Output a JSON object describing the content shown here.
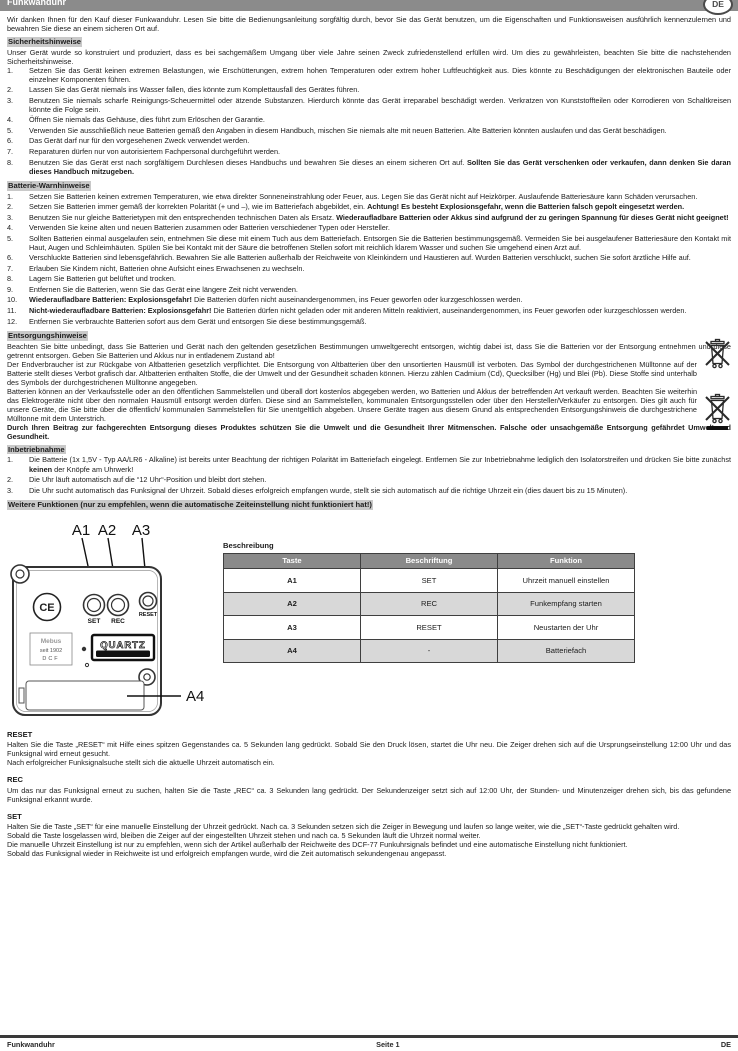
{
  "header": {
    "title": "Funkwanduhr",
    "lang_badge": "DE"
  },
  "intro": "Wir danken Ihnen für den Kauf dieser Funkwanduhr. Lesen Sie bitte die Bedienungsanleitung sorgfältig durch, bevor Sie das Gerät benutzen, um die Eigenschaften und Funktionsweisen ausführlich kennenzulernen und bewahren Sie diese an einem sicheren Ort auf.",
  "safety": {
    "heading": "Sicherheitshinweise",
    "intro": "Unser Gerät wurde so konstruiert und produziert, dass es bei sachgemäßem Umgang über viele Jahre seinen Zweck zufriedenstellend erfüllen wird. Um dies zu gewährleisten, beachten Sie bitte die nachstehenden Sicherheitshinweise.",
    "items": [
      {
        "num": "1.",
        "seg": [
          {
            "t": "Setzen Sie das Gerät keinen extremen Belastungen, wie Erschütterungen, extrem hohen Temperaturen oder extrem hoher Luftfeuchtigkeit aus. Dies könnte zu Beschädigungen der elektronischen Bauteile oder einzelner Komponenten führen."
          }
        ]
      },
      {
        "num": "2.",
        "seg": [
          {
            "t": "Lassen Sie das Gerät niemals ins Wasser fallen, dies könnte zum Komplettausfall des Gerätes führen."
          }
        ]
      },
      {
        "num": "3.",
        "seg": [
          {
            "t": "Benutzen Sie niemals scharfe Reinigungs-Scheuermittel oder ätzende Substanzen. Hierdurch könnte das Gerät irreparabel beschädigt werden. Verkratzen von Kunststoffteilen oder Korrodieren von Schaltkreisen könnte die Folge sein."
          }
        ]
      },
      {
        "num": "4.",
        "seg": [
          {
            "t": "Öffnen Sie niemals das Gehäuse, dies führt zum Erlöschen der Garantie."
          }
        ]
      },
      {
        "num": "5.",
        "seg": [
          {
            "t": "Verwenden Sie ausschließlich neue Batterien gemäß den Angaben in diesem Handbuch, mischen Sie niemals alte mit neuen Batterien. Alte Batterien könnten auslaufen und das Gerät beschädigen."
          }
        ]
      },
      {
        "num": "6.",
        "seg": [
          {
            "t": "Das Gerät darf nur für den vorgesehenen Zweck verwendet werden."
          }
        ]
      },
      {
        "num": "7.",
        "seg": [
          {
            "t": "Reparaturen dürfen nur von autorisiertem Fachpersonal durchgeführt werden."
          }
        ]
      },
      {
        "num": "8.",
        "seg": [
          {
            "t": "Benutzen Sie das Gerät erst nach sorgfältigem Durchlesen dieses Handbuchs und bewahren Sie dieses an einem sicheren Ort auf. "
          },
          {
            "t": "Sollten Sie das Gerät verschenken oder verkaufen, dann denken Sie daran dieses Handbuch mitzugeben.",
            "b": true
          }
        ]
      }
    ]
  },
  "battery": {
    "heading": "Batterie-Warnhinweise",
    "items": [
      {
        "num": "1.",
        "seg": [
          {
            "t": "Setzen Sie Batterien keinen extremen Temperaturen, wie etwa direkter Sonneneinstrahlung oder Feuer, aus. Legen Sie das Gerät nicht auf Heizkörper. Auslaufende Batteriesäure kann Schäden verursachen."
          }
        ]
      },
      {
        "num": "2.",
        "seg": [
          {
            "t": "Setzen Sie Batterien immer gemäß der korrekten Polarität (+ und –), wie im Batteriefach abgebildet, ein. "
          },
          {
            "t": "Achtung! Es besteht Explosionsgefahr, wenn die Batterien falsch gepolt eingesetzt werden.",
            "b": true
          }
        ]
      },
      {
        "num": "3.",
        "seg": [
          {
            "t": "Benutzen Sie nur gleiche Batterietypen mit den entsprechenden technischen Daten als Ersatz. "
          },
          {
            "t": "Wiederaufladbare Batterien oder Akkus sind aufgrund der zu geringen Spannung für dieses Gerät nicht geeignet!",
            "b": true
          }
        ]
      },
      {
        "num": "4.",
        "seg": [
          {
            "t": "Verwenden Sie keine alten und neuen Batterien zusammen oder Batterien verschiedener Typen oder Hersteller."
          }
        ]
      },
      {
        "num": "5.",
        "seg": [
          {
            "t": "Sollten Batterien einmal ausgelaufen sein, entnehmen Sie diese mit einem Tuch aus dem Batteriefach. Entsorgen Sie die Batterien bestimmungsgemäß. Vermeiden Sie bei ausgelaufener Batteriesäure den Kontakt mit Haut, Augen und Schleimhäuten. Spülen Sie bei Kontakt mit der Säure die betroffenen Stellen sofort mit reichlich klarem Wasser und suchen Sie umgehend einen Arzt auf."
          }
        ]
      },
      {
        "num": "6.",
        "seg": [
          {
            "t": "Verschluckte Batterien sind lebensgefährlich. Bewahren Sie alle Batterien außerhalb der Reichweite von Kleinkindern und Haustieren auf. Wurden Batterien verschluckt, suchen Sie sofort ärztliche Hilfe auf."
          }
        ]
      },
      {
        "num": "7.",
        "seg": [
          {
            "t": "Erlauben Sie Kindern nicht, Batterien ohne Aufsicht eines Erwachsenen zu wechseln."
          }
        ]
      },
      {
        "num": "8.",
        "seg": [
          {
            "t": "Lagern Sie Batterien gut belüftet und trocken."
          }
        ]
      },
      {
        "num": "9.",
        "seg": [
          {
            "t": "Entfernen Sie die Batterien, wenn Sie das Gerät eine längere Zeit nicht verwenden."
          }
        ]
      },
      {
        "num": "10.",
        "seg": [
          {
            "t": "Wiederaufladbare Batterien: Explosionsgefahr! ",
            "b": true
          },
          {
            "t": "Die Batterien dürfen nicht auseinandergenommen, ins Feuer geworfen oder kurzgeschlossen werden."
          }
        ]
      },
      {
        "num": "11.",
        "seg": [
          {
            "t": "Nicht-wiederaufladbare Batterien: Explosionsgefahr! ",
            "b": true
          },
          {
            "t": "Die Batterien dürfen nicht geladen oder mit anderen Mitteln reaktiviert, auseinandergenommen, ins Feuer geworfen oder kurzgeschlossen werden."
          }
        ]
      },
      {
        "num": "12.",
        "seg": [
          {
            "t": "Entfernen Sie verbrauchte Batterien sofort aus dem Gerät und entsorgen Sie diese bestimmungsgemäß."
          }
        ]
      }
    ]
  },
  "disposal": {
    "heading": "Entsorgungshinweise",
    "paragraphs": [
      {
        "seg": [
          {
            "t": "Beachten Sie bitte unbedingt, dass Sie Batterien und Gerät nach den geltenden gesetzlichen Bestimmungen umweltgerecht entsorgen, wichtig dabei ist, dass Sie die Batterien vor der Entsorgung entnehmen und diese getrennt entsorgen. Geben Sie Batterien und Akkus nur in entladenem Zustand ab!"
          }
        ]
      },
      {
        "seg": [
          {
            "t": "Der Endverbraucher ist zur Rückgabe von Altbatterien gesetzlich verpflichtet. Die Entsorgung von Altbatterien über den unsortierten Hausmüll ist verboten. Das Symbol der durchgestrichenen Mülltonne auf der Batterie stellt dieses Verbot grafisch dar. Altbatterien enthalten Stoffe, die der Umwelt und der Gesundheit schaden können. Hierzu zählen Cadmium (Cd), Quecksilber (Hg) und Blei (Pb). Diese Stoffe sind unterhalb des Symbols der durchgestrichenen Mülltonne angegeben."
          }
        ]
      },
      {
        "seg": [
          {
            "t": "Batterien können an der Verkaufsstelle oder an den öffentlichen Sammelstellen und überall dort kostenlos abgegeben werden, wo Batterien und Akkus der betreffenden Art verkauft werden. Beachten Sie weiterhin das Elektrogeräte nicht über den normalen Hausmüll entsorgt werden dürfen. Diese sind an Sammelstellen, kommunalen Entsorgungsstellen oder über den Hersteller/Verkäufer zu entsorgen. Dies gilt auch für unsere Geräte, die Sie bitte über die öffentlich/ kommunalen Sammelstellen für Sie unentgeltlich abgeben. Unsere Geräte tragen aus diesem Grund als entsprechenden Entsorgungshinweis die durchgestrichene Mülltonne mit dem Unterstrich."
          }
        ]
      },
      {
        "seg": [
          {
            "t": "Durch Ihren Beitrag zur fachgerechten Entsorgung dieses Produktes schützen Sie die Umwelt und die Gesundheit Ihrer Mitmenschen. Falsche oder unsachgemäße Entsorgung gefährdet Umwelt und Gesundheit.",
            "b": true
          }
        ]
      }
    ]
  },
  "setup": {
    "heading": "Inbetriebnahme",
    "items": [
      {
        "num": "1.",
        "seg": [
          {
            "t": "Die Batterie (1x 1,5V - Typ AA/LR6 - Alkaline) ist bereits unter Beachtung der richtigen Polarität im Batteriefach eingelegt. Entfernen Sie zur Inbetriebnahme lediglich den Isolatorstreifen und drücken Sie bitte zunächst "
          },
          {
            "t": "keinen",
            "b": true
          },
          {
            "t": " der Knöpfe am Uhrwerk!"
          }
        ]
      },
      {
        "num": "2.",
        "seg": [
          {
            "t": "Die Uhr läuft automatisch auf die “12 Uhr“-Position und bleibt dort stehen."
          }
        ]
      },
      {
        "num": "3.",
        "seg": [
          {
            "t": "Die Uhr sucht automatisch das Funksignal der Uhrzeit. Sobald dieses erfolgreich empfangen wurde, stellt sie sich automatisch auf die richtige Uhrzeit ein (dies dauert bis zu 15 Minuten)."
          }
        ]
      }
    ]
  },
  "more_functions": {
    "heading": "Weitere Funktionen (nur zu empfehlen, wenn die automatische Zeiteinstellung nicht funktioniert hat!)"
  },
  "diagram": {
    "labels": {
      "a1": "A1",
      "a2": "A2",
      "a3": "A3",
      "a4": "A4"
    },
    "buttons": {
      "set": "SET",
      "rec": "REC",
      "reset": "RESET"
    },
    "ce_mark": "CE",
    "badge": "QUARTZ",
    "sticker": {
      "line1": "Mebus",
      "line2": "seit 1902",
      "line3": "DCF"
    }
  },
  "table": {
    "title": "Beschreibung",
    "headers": [
      "Taste",
      "Beschriftung",
      "Funktion"
    ],
    "rows": [
      [
        "A1",
        "SET",
        "Uhrzeit manuell einstellen"
      ],
      [
        "A2",
        "REC",
        "Funkempfang starten"
      ],
      [
        "A3",
        "RESET",
        "Neustarten der Uhr"
      ],
      [
        "A4",
        "-",
        "Batteriefach"
      ]
    ]
  },
  "reset_section": {
    "heading": "RESET",
    "paragraphs": [
      "Halten Sie die Taste „RESET“ mit Hilfe eines spitzen Gegenstandes ca. 5 Sekunden lang gedrückt. Sobald Sie den Druck lösen, startet die Uhr neu. Die Zeiger drehen sich auf die Ursprungseinstellung 12:00 Uhr und das Funksignal wird erneut gesucht.",
      "Nach erfolgreicher Funksignalsuche stellt sich die aktuelle Uhrzeit automatisch ein."
    ]
  },
  "rec_section": {
    "heading": "REC",
    "paragraphs": [
      "Um das nur das Funksignal erneut zu suchen, halten Sie die Taste „REC“ ca. 3 Sekunden lang gedrückt. Der Sekundenzeiger setzt sich auf 12:00 Uhr, der Stunden- und Minutenzeiger drehen sich, bis das gefundene Funksignal erkannt wurde."
    ]
  },
  "set_section": {
    "heading": "SET",
    "paragraphs": [
      "Halten Sie die Taste „SET“ für eine manuelle Einstellung der Uhrzeit gedrückt. Nach ca. 3 Sekunden setzen sich die Zeiger in Bewegung und laufen so lange weiter, wie die „SET“-Taste gedrückt gehalten wird.",
      "Sobald die Taste losgelassen wird, bleiben die Zeiger auf der eingestellten Uhrzeit stehen und nach ca. 5 Sekunden läuft die Uhrzeit normal weiter.",
      "Die manuelle Uhrzeit Einstellung ist nur zu empfehlen, wenn sich der Artikel außerhalb der Reichweite des DCF-77 Funkuhrsignals befindet und eine automatische Einstellung nicht funktioniert.",
      "Sobald das Funksignal wieder in Reichweite ist und erfolgreich empfangen wurde, wird die Zeit automatisch sekundengenau angepasst."
    ]
  },
  "footer": {
    "left": "Funkwanduhr",
    "center": "Seite 1",
    "right": "DE"
  },
  "colors": {
    "header_bar": "#8b8b8b",
    "heading_highlight": "#c9c9c9",
    "table_header": "#8a8a8a",
    "table_alt_row": "#d8d8d8"
  }
}
